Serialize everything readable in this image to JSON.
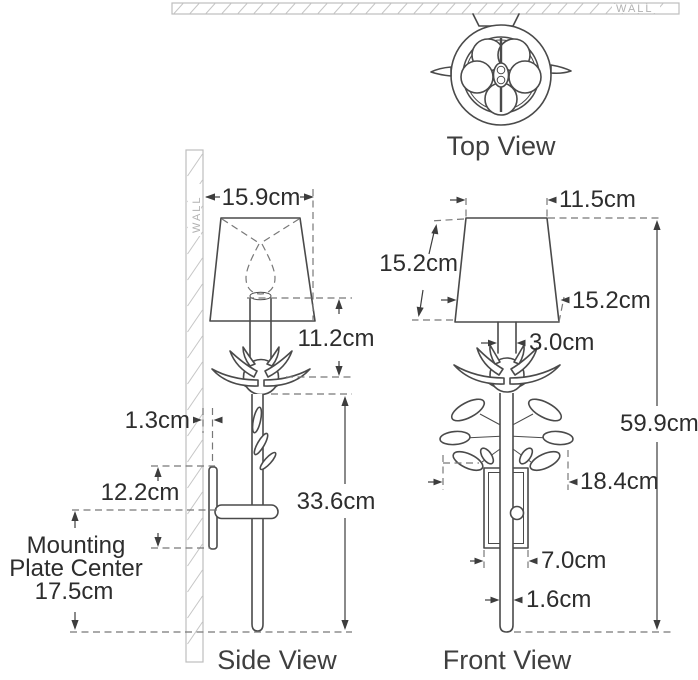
{
  "wall_label": "WALL",
  "views": {
    "top": {
      "label": "Top View"
    },
    "side": {
      "label": "Side View"
    },
    "front": {
      "label": "Front View"
    }
  },
  "side_view_dimensions": {
    "shade_depth": "15.9cm",
    "shade_to_flower": "11.2cm",
    "wall_gap": "1.3cm",
    "backplate_height": "12.2cm",
    "mounting_label_line1": "Mounting",
    "mounting_label_line2": "Plate Center",
    "mounting_label_line3": "17.5cm",
    "stem_height": "33.6cm"
  },
  "front_view_dimensions": {
    "shade_top_width": "11.5cm",
    "shade_slant_height": "15.2cm",
    "shade_bottom_width": "15.2cm",
    "candle_width": "3.0cm",
    "overall_height": "59.9cm",
    "leaf_span": "18.4cm",
    "backplate_width": "7.0cm",
    "stem_width": "1.6cm"
  },
  "colors": {
    "line": "#4a4a4a",
    "dimension_text": "#2d2d2d",
    "wall_hatch": "#c6c6c6",
    "wall_text": "#b2b2b2"
  }
}
